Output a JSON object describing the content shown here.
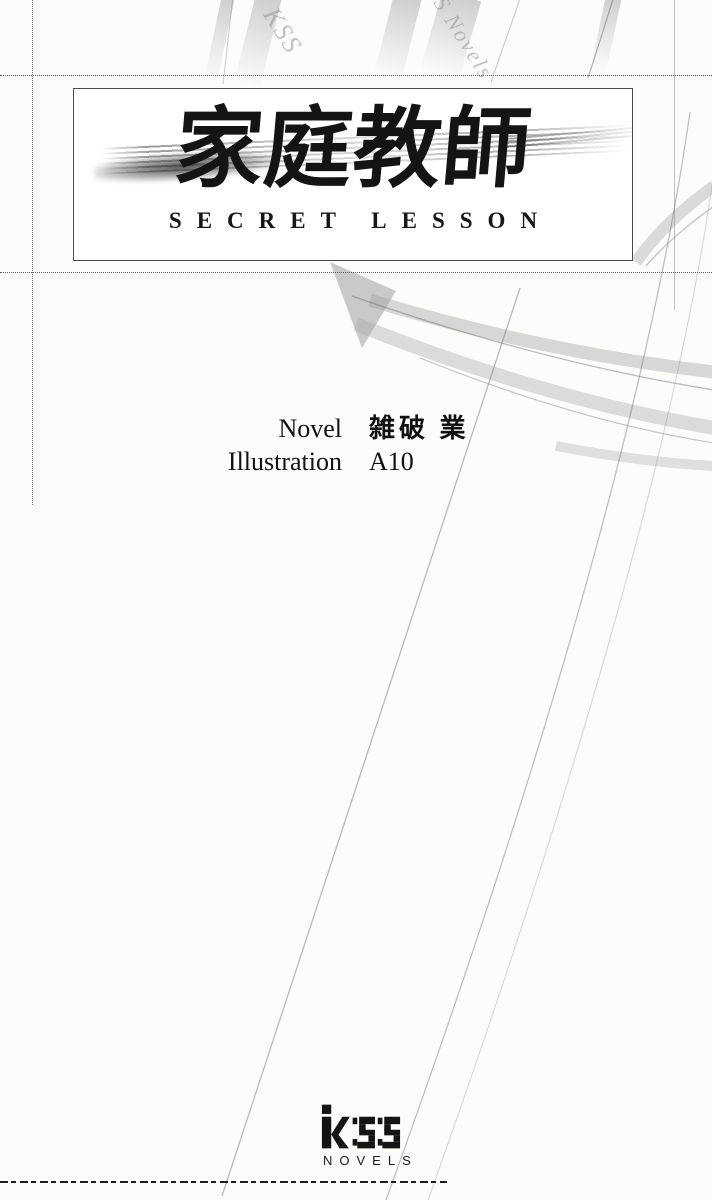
{
  "document": {
    "kind": "novel title page"
  },
  "title_box": {
    "title": "家庭教師",
    "subtitle": "SECRET LESSON"
  },
  "credits": {
    "novel_label": "Novel",
    "novel_value": "雑破 業",
    "illustration_label": "Illustration",
    "illustration_value": "A10"
  },
  "watermarks": {
    "top_left": "KSS",
    "top_right": "S Novels"
  },
  "publisher": {
    "name": "KSS",
    "imprint": "NOVELS"
  },
  "colors": {
    "ink": "#141414",
    "paper": "#fcfcfb",
    "faint_gray": "#aaaaaa"
  }
}
